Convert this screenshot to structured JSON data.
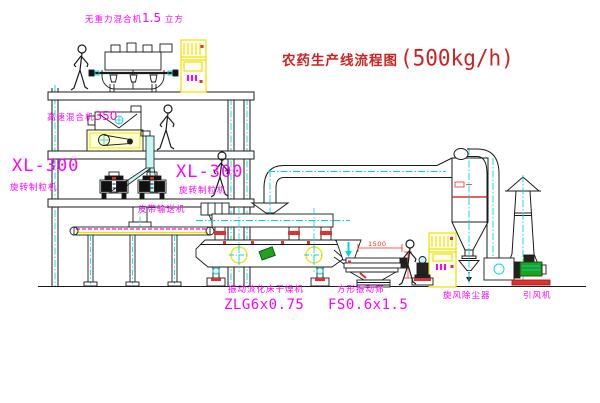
{
  "title": {
    "text": "农药生产线流程图",
    "capacity": "(500kg/h)"
  },
  "labels": {
    "top_mixer": {
      "name": "无重力混合机",
      "size": "1.5",
      "unit": "立方"
    },
    "high_speed_mixer": {
      "name": "高速混合机",
      "size": "350"
    },
    "granulator_left": {
      "model": "XL-300",
      "name": "旋转制粒机"
    },
    "granulator_mid": {
      "model": "XL-300",
      "name": "旋转制粒机"
    },
    "belt_conveyor": "皮带输送机",
    "dryer": {
      "name": "振动流化床干燥机",
      "model": "ZLG6x0.75"
    },
    "sieve": {
      "name": "方形振动筛",
      "model": "FS0.6x1.5"
    },
    "cyclone": "旋风除尘器",
    "fan": "引风机"
  },
  "dimensions": {
    "sieve_width": "1500"
  },
  "colors": {
    "line": "#1b1b1b",
    "centerline": "#00d8d8",
    "equipment_accent": "#f0e000",
    "label": "#ff00ff",
    "title": "#cc2222",
    "dimension": "#ff2222"
  }
}
